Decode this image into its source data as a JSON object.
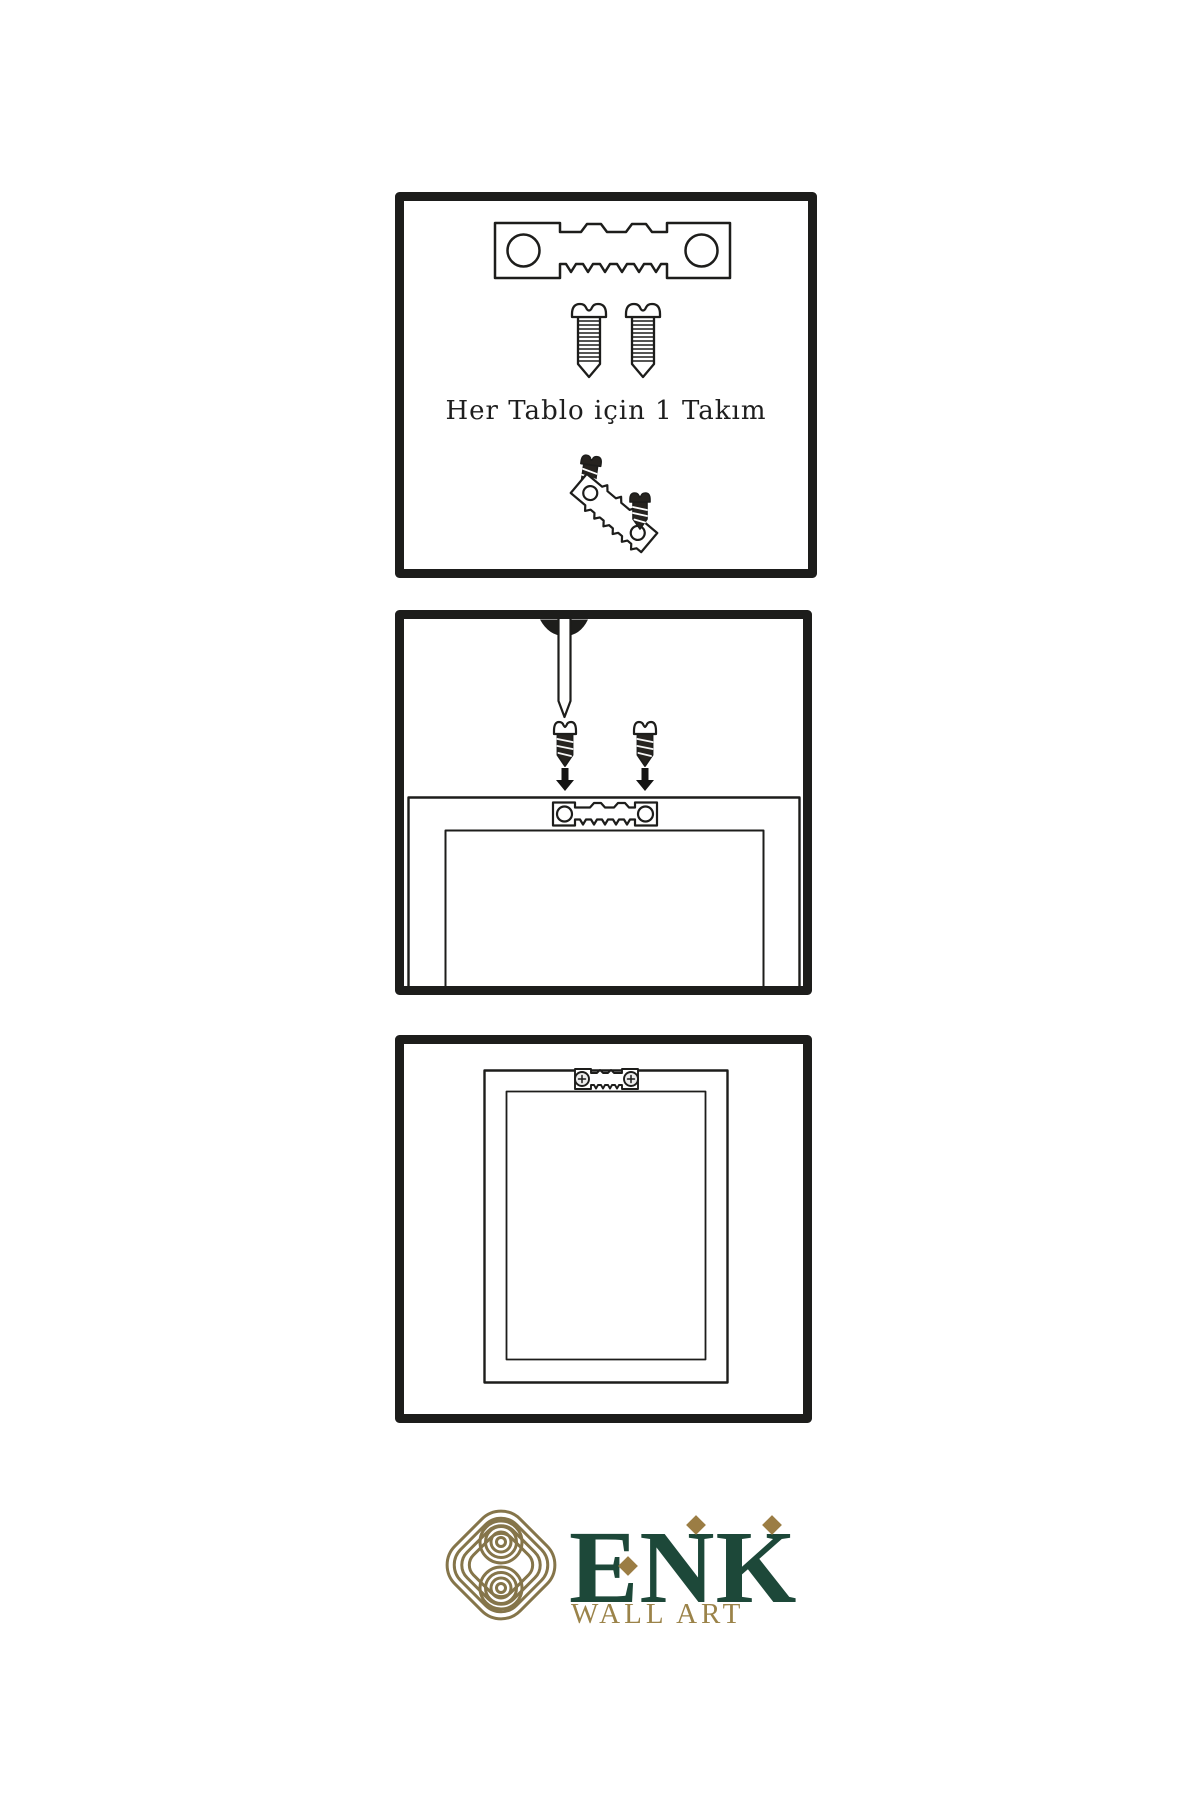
{
  "colors": {
    "background": "#ffffff",
    "ink": "#1d1d1b",
    "brand_green": "#1d4839",
    "brand_gold": "#9b8349",
    "knot_gold": "#85754a",
    "accent_diamond": "#9b7d44"
  },
  "steps": {
    "step1": {
      "caption": "Her Tablo için 1 Takım",
      "illustrations": [
        "sawtooth-hanger-icon",
        "screw-icon",
        "screw-icon",
        "dark-screw-icon",
        "angled-sawtooth-hanger-icon",
        "dark-screw-icon"
      ]
    },
    "step2": {
      "illustrations": [
        "wall-nail-icon",
        "dark-screw-icon",
        "dark-screw-icon",
        "arrow-down-icon",
        "arrow-down-icon",
        "frame-back-with-sawtooth-hanger"
      ]
    },
    "step3": {
      "illustrations": [
        "frame-back-with-mounted-hanger"
      ]
    }
  },
  "logo": {
    "symbol": "knot-logo-icon",
    "brand_letters": [
      "E",
      "N",
      "K"
    ],
    "tagline": "WALL ART"
  }
}
